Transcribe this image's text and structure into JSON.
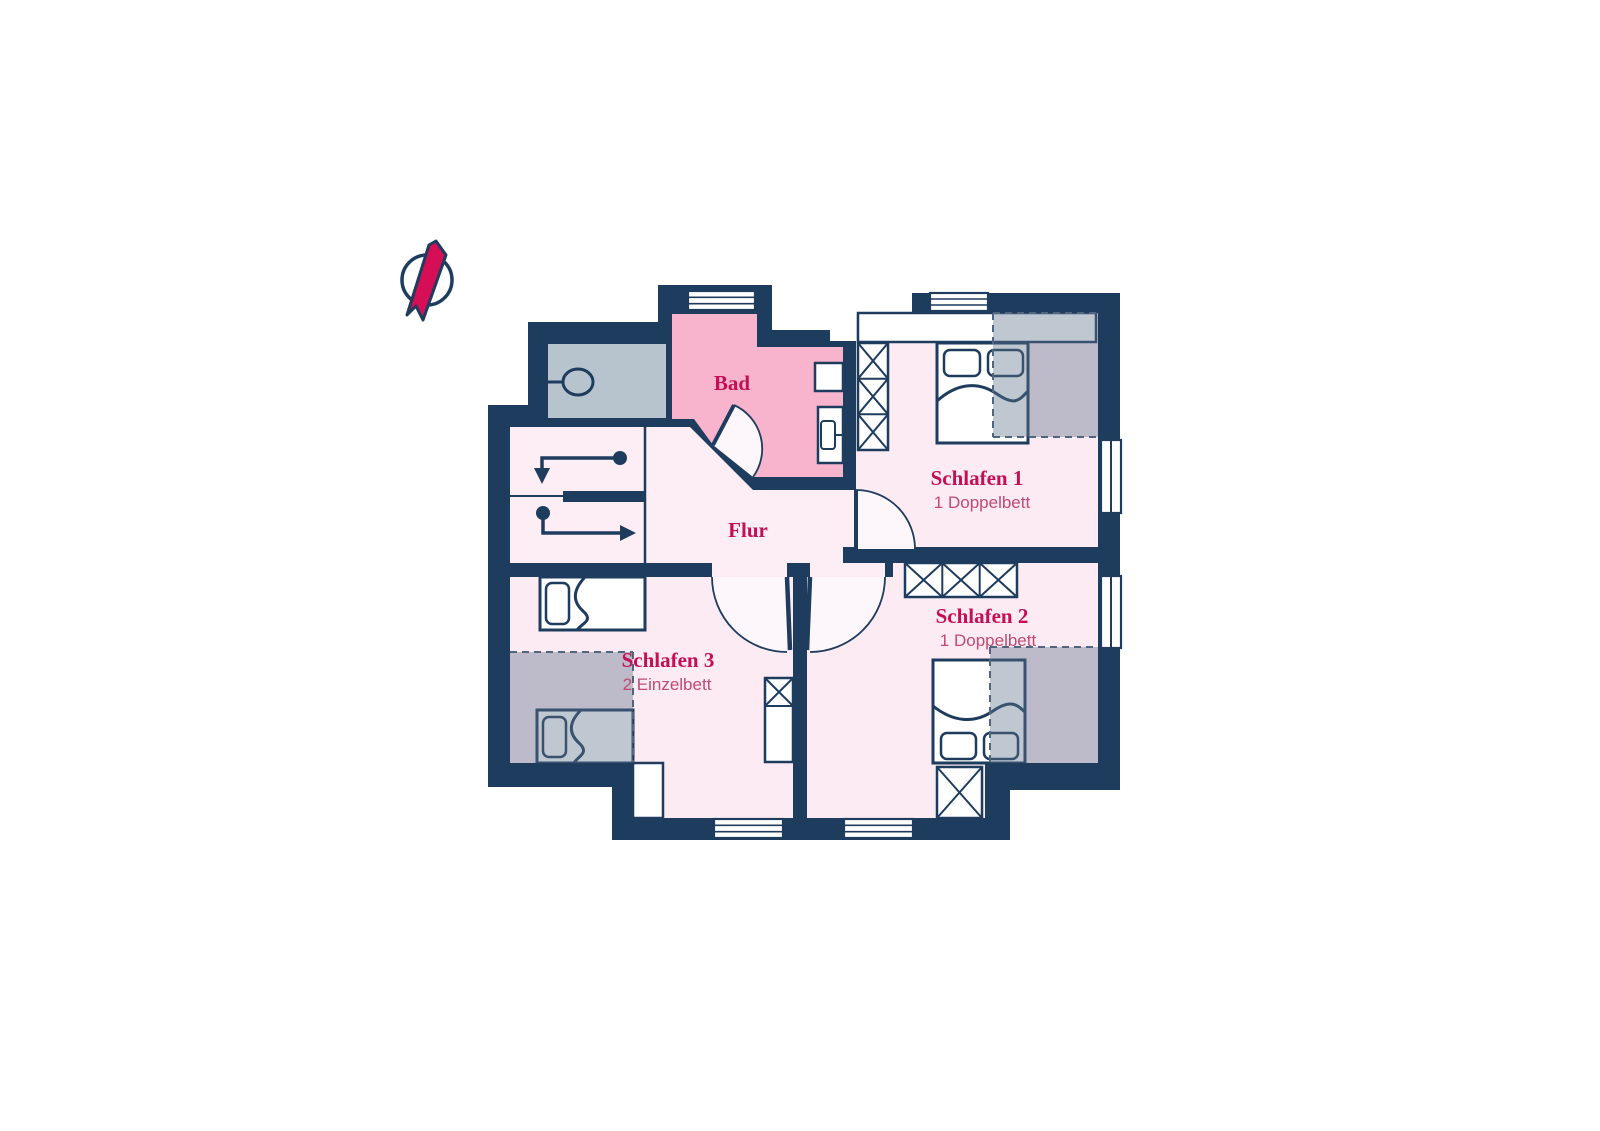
{
  "type": "floor-plan",
  "rooms": {
    "bad": {
      "label": "Bad"
    },
    "flur": {
      "label": "Flur"
    },
    "schlafen1": {
      "label": "Schlafen 1",
      "beds": "1 Doppelbett"
    },
    "schlafen2": {
      "label": "Schlafen 2",
      "beds": "1 Doppelbett"
    },
    "schlafen3": {
      "label": "Schlafen 3",
      "beds": "2 Einzelbett"
    }
  },
  "colors": {
    "wall_navy": "#1e3c5e",
    "room_pink": "#fcebf2",
    "hall_pink": "#fdeef5",
    "bath_pink": "#f9b4cd",
    "door_swing": "#fdf6fa",
    "utility_gray": "#b7c3cd",
    "sloped_ceiling_overlay": "rgba(96,116,140,0.40)",
    "dash_gray": "#51667e",
    "heading_crimson": "#c40f56",
    "subtitle_rose": "#c04a75",
    "needle_red": "#d60e55"
  },
  "icons": {
    "north_arrow": "compass-north-needle",
    "stairs": "stair-direction-arrows",
    "bath_fixtures": [
      "washbasin",
      "toilet",
      "sink"
    ],
    "furniture": [
      "double-bed",
      "single-bed",
      "wardrobe-x",
      "sideboard"
    ],
    "openings": [
      "window",
      "door-swing"
    ]
  }
}
